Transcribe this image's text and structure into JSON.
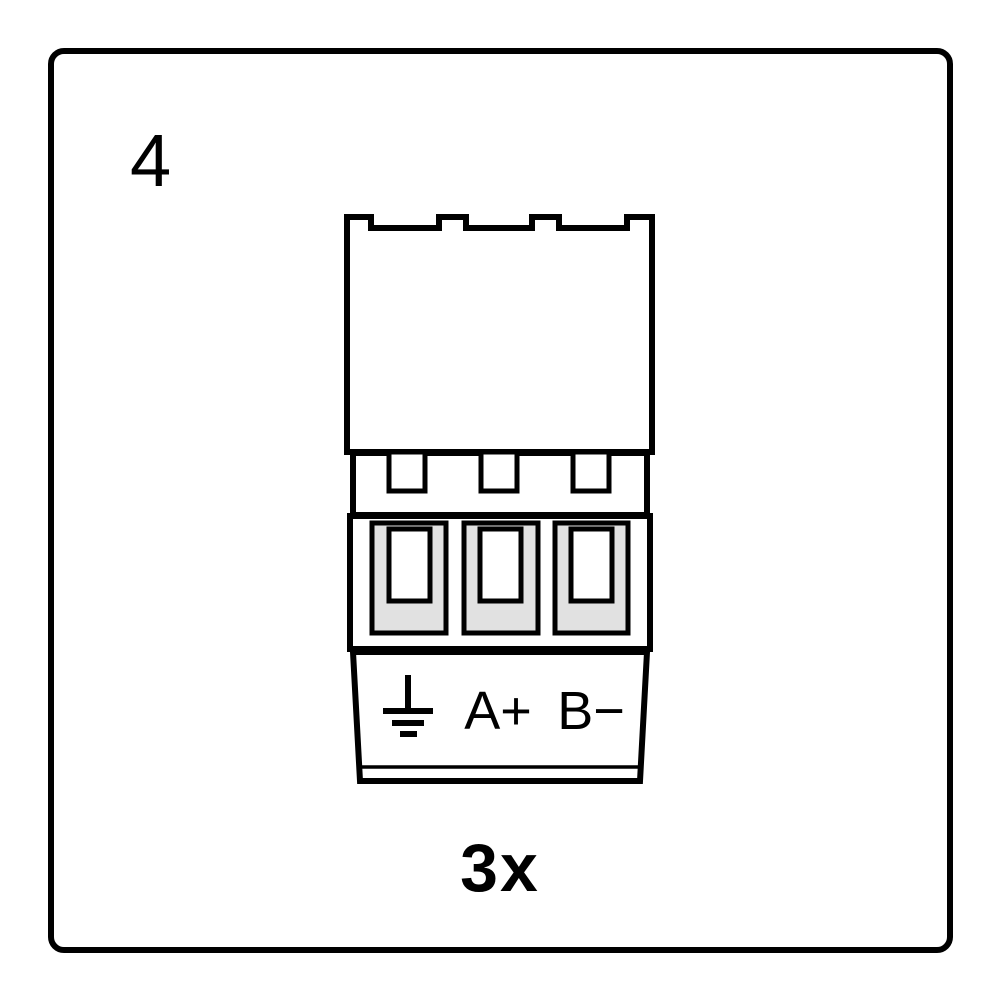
{
  "step_number": "4",
  "quantity": "3x",
  "connector": {
    "pin_count": 3,
    "labels": {
      "a": "A+",
      "b": "B−"
    },
    "ground_icon": "earth-ground-symbol"
  },
  "colors": {
    "outline": "#000000",
    "body_fill": "#ffffff",
    "terminal_gray": "#e1e1e1",
    "background": "#ffffff"
  }
}
